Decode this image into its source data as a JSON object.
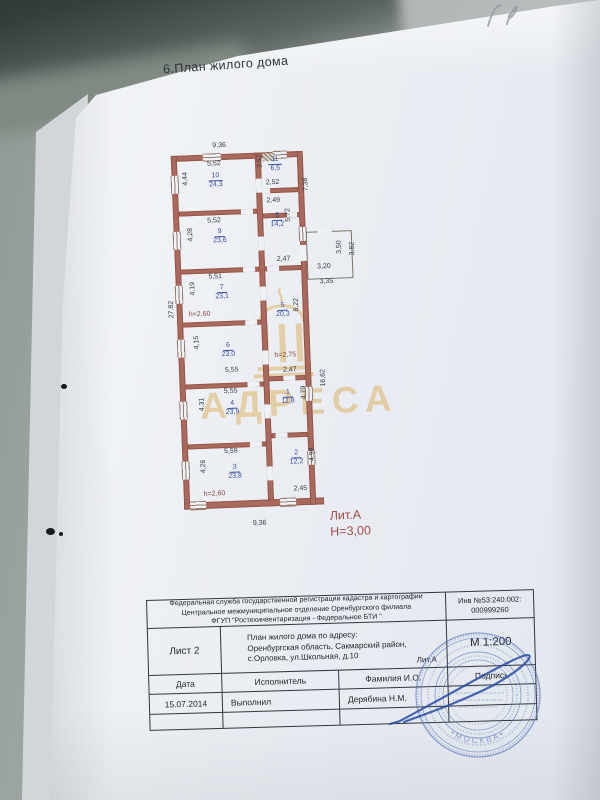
{
  "header": {
    "title": "6.План жилого дома"
  },
  "plan": {
    "rooms": {
      "r10": {
        "num": "10",
        "area": "24,3"
      },
      "r9": {
        "num": "9",
        "area": "23,6"
      },
      "r7": {
        "num": "7",
        "area": "23,1"
      },
      "r6": {
        "num": "6",
        "area": "23,0"
      },
      "r4": {
        "num": "4",
        "area": "23,9"
      },
      "r3": {
        "num": "3",
        "area": "23,8"
      },
      "r11": {
        "num": "11",
        "area": "6,5"
      },
      "r8": {
        "num": "8",
        "area": "14,2"
      },
      "r5": {
        "num": "5",
        "area": "20,3"
      },
      "r1": {
        "num": "1",
        "area": "11,8"
      },
      "r2": {
        "num": "2",
        "area": "12,2"
      }
    },
    "dims": {
      "top_overall": "9,36",
      "bottom_overall": "9,36",
      "left_overall": "27,82",
      "right_upper": "7,38",
      "right_lower": "16,62",
      "r10_w": "5,52",
      "r10_h": "4,44",
      "r9_w": "5,52",
      "r9_h": "4,28",
      "r7_w": "5,51",
      "r7_h": "4,19",
      "r6_w": "5,55",
      "r6_h": "4,15",
      "r4_w": "5,55",
      "r4_h": "4,31",
      "r3_w": "5,59",
      "r3_h": "4,26",
      "r11_w": "2,52",
      "r11_h": "2,57",
      "hall_w": "2,49",
      "r8_h": "5,72",
      "r5_w": "2,47",
      "r5_h": "8,22",
      "r1_w": "2,47",
      "r1_h": "4,79",
      "r2_w": "2,45",
      "r2_h": "4,98",
      "ext_w1": "3,20",
      "ext_w2": "3,35",
      "ext_h1": "3,50",
      "ext_h2": "3,82"
    },
    "notes": {
      "h7": "h=2,60",
      "h5": "h=2,75",
      "h3": "h=2,60"
    },
    "litera": "Лит.А",
    "height_note": "Н=3,00"
  },
  "watermark": {
    "text": "АДРЕСА"
  },
  "title_block": {
    "org_line1": "Федеральная служба государственной регистрации кадастра и картографии",
    "org_line2": "Центральное межмуниципальное отделение Оренбургского филиала",
    "org_line3": "ФГУП \"Ростехинвентаризация - Федеральное БТИ \"",
    "inv_label": "Инв №53:240:002:",
    "inv_number": "000999260",
    "sheet": "Лист 2",
    "addr_line1": "План жилого дома по адресу:",
    "addr_line2": "Оренбургская область, Сакмарский район,",
    "addr_line3": "с.Орловка, ул.Школьная, д.10",
    "litera": "Лит.А",
    "scale": "М 1:200",
    "col_date": "Дата",
    "col_executor": "Исполнитель",
    "col_name": "Фамилия И.О.",
    "col_sign": "Подпись",
    "date": "15.07.2014",
    "executor_role": "Выполнил",
    "executor_name": "Дерябина Н.М."
  },
  "stamp": {
    "city": "МОСКВА"
  },
  "colors": {
    "wall": "#a9695c",
    "room_label": "#3850a0",
    "dim_text": "#363c47",
    "litera_red": "#a14f44",
    "stamp_blue": "#4d6fbe",
    "watermark": "#ddb569",
    "signature": "#2b4da3"
  }
}
